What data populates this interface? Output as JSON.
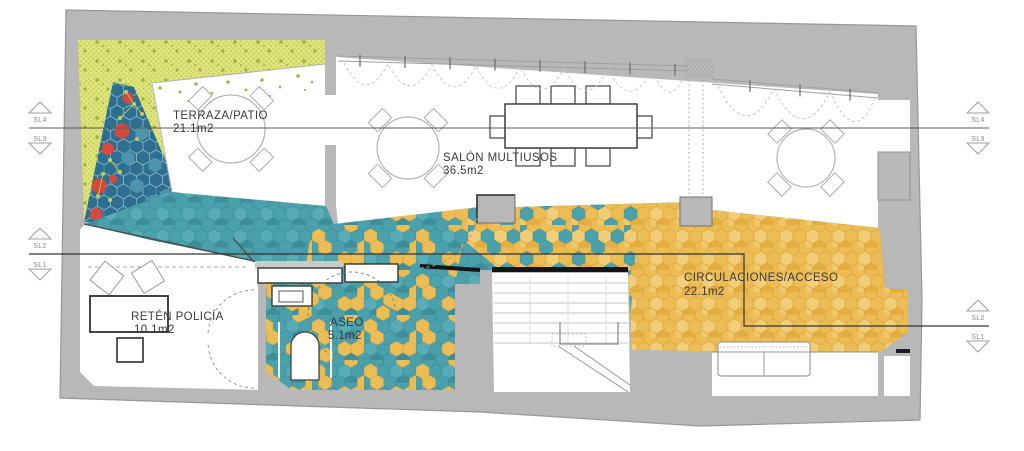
{
  "plan": {
    "rooms": {
      "terraza": {
        "name": "TERRAZA/PATIO",
        "area": "21.1m2"
      },
      "salon": {
        "name": "SALÓN MULTIUSOS",
        "area": "36.5m2"
      },
      "circulaciones": {
        "name": "CIRCULACIONES/ACCESO",
        "area": "22.1m2"
      },
      "reten": {
        "name": "RETÉN POLICÍA",
        "area": "10.1m2"
      },
      "aseo": {
        "name": "ASEO",
        "area": "5.1m2"
      }
    },
    "section_markers": {
      "sl4": "SL4",
      "sl3": "SL3",
      "sl2": "SL2",
      "sl1": "SL1"
    },
    "colors": {
      "floor_teal": "#4aa0ab",
      "floor_orange": "#ecbc55",
      "terrace_yellow": "#e0e47c",
      "planting_blue": "#2d6f90",
      "accent_red": "#d7493d",
      "wall_gray": "#b8b8b8"
    }
  }
}
